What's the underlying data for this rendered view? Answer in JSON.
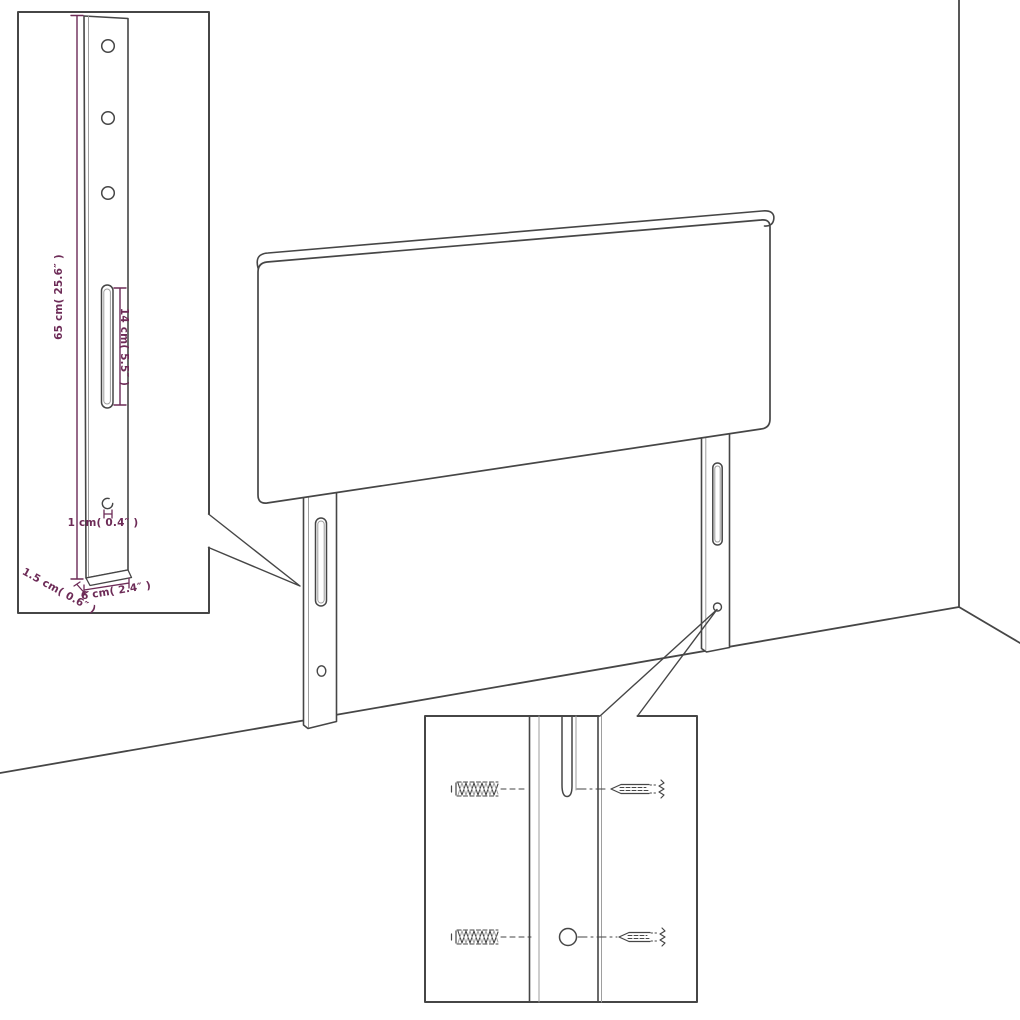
{
  "diagram": {
    "subject": "headboard-with-legs wall assembly illustration",
    "background_color": "#ffffff",
    "line_color": "#464646",
    "line_color_light": "#9e9e9e",
    "dimension_color": "#6d2b57",
    "labels": {
      "height": "65 cm( 25.6″ )",
      "slot": "14 cm( 5.5″ )",
      "hole": "1 cm( 0.4″ )",
      "depth": "1.5 cm( 0.6″ )",
      "width": "6 cm( 2.4″ )"
    }
  }
}
